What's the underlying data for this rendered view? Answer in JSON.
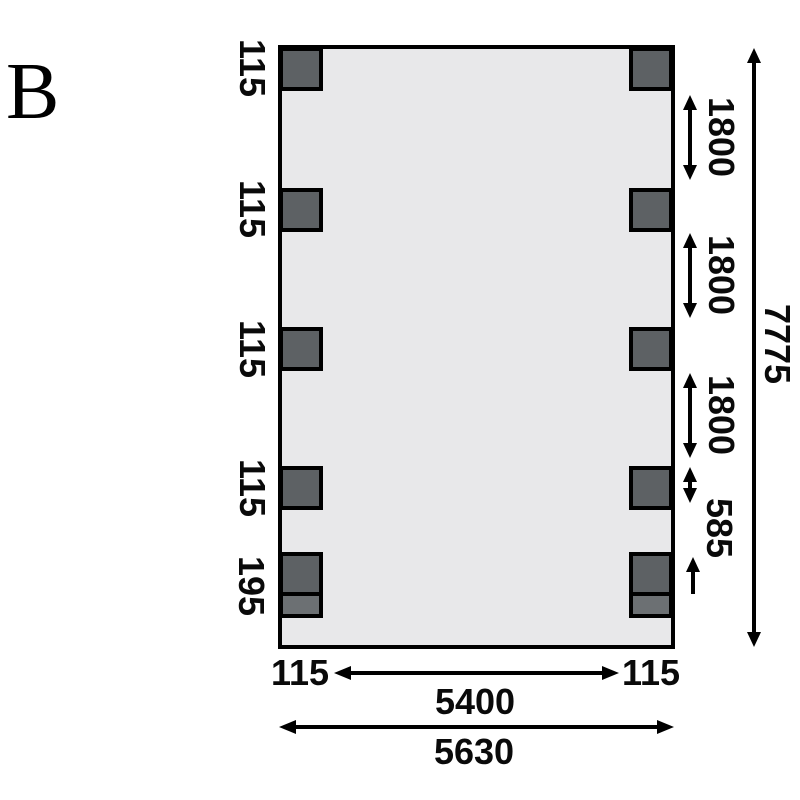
{
  "figure_label": "B",
  "plan": {
    "fill_color": "#e8e8ea",
    "outline_color": "#000000",
    "post_fill_color": "#5d6164",
    "post_foot_fill_color": "#6c7073"
  },
  "left_dimensions": {
    "post_labels": [
      "115",
      "115",
      "115",
      "115",
      "195"
    ]
  },
  "right_dimensions": {
    "spacings": [
      "1800",
      "1800",
      "1800"
    ],
    "gap": "585",
    "total_height": "7775"
  },
  "bottom_dimensions": {
    "left_post_width": "115",
    "right_post_width": "115",
    "inner_width": "5400",
    "total_width": "5630"
  }
}
